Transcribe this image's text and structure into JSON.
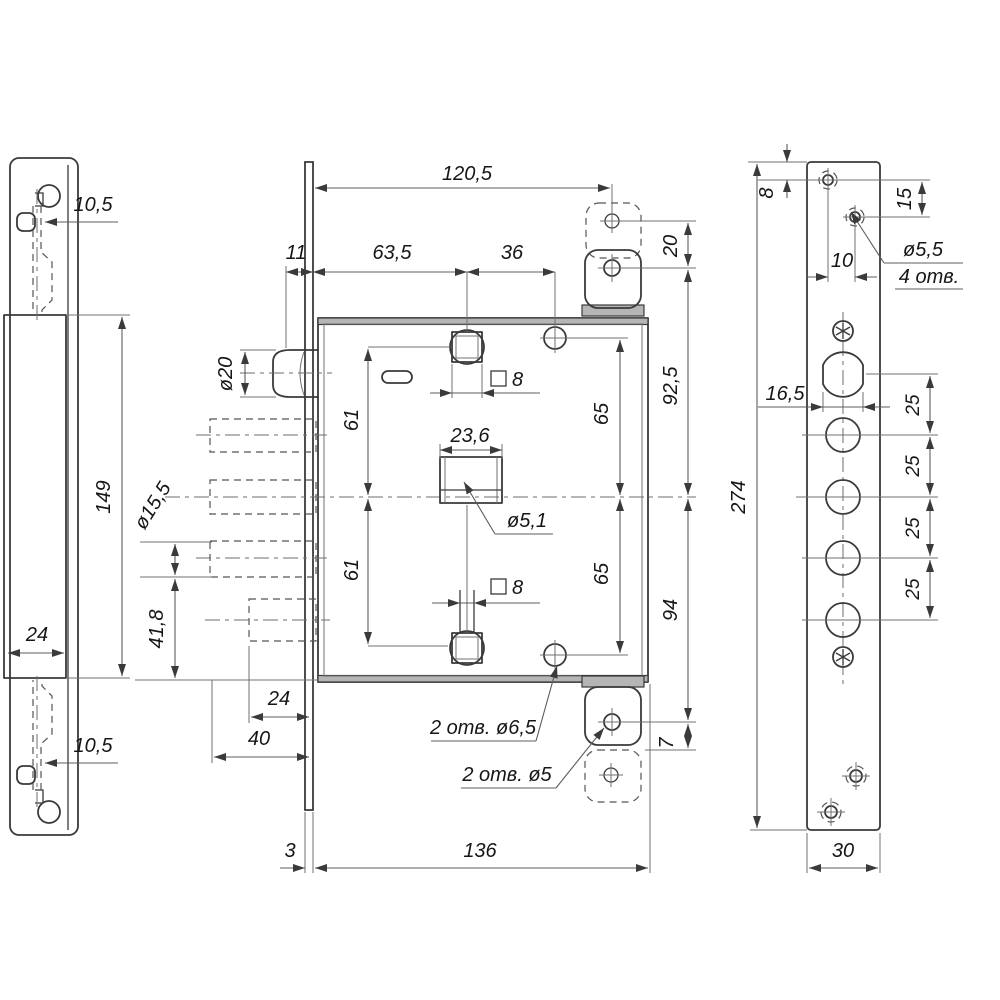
{
  "meta": {
    "drawing_type": "technical drawing, mortise lock: strike box (left), lock body (middle), faceplate (right)",
    "background": "#ffffff",
    "line_color": "#3a3a3a",
    "section_fill": "#b5b5b5"
  },
  "labels": {
    "strike_offset_top": "10,5",
    "strike_box_height": "149",
    "strike_box_width": "24",
    "strike_offset_bottom": "10,5",
    "body_overall_width": "120,5",
    "body_face_gap": "11",
    "body_backset": "63,5",
    "body_spindle_to_hole": "36",
    "keeper_hole_gap": "20",
    "body_upper_span": "92,5",
    "body_lower_span": "94",
    "keeper_lower_gap": "7",
    "spindle_upper": "61",
    "spindle_lower": "61",
    "hole_upper": "65",
    "hole_lower": "65",
    "cyl_slot_width": "23,6",
    "cyl_pin_dia": "ø5,1",
    "square_top": "8",
    "square_bottom": "8",
    "latch_dia": "ø20",
    "bolt_dia": "ø15,5",
    "bolt_edge_offset": "41,8",
    "aux_bolt_width": "24",
    "bolt_throw": "40",
    "face_thickness": "3",
    "body_width": "136",
    "note_two_holes_65": "2 отв. ø6,5",
    "note_two_holes_5": "2 отв. ø5",
    "fp_top_offset": "8",
    "fp_hole_v": "15",
    "fp_hole_h": "10",
    "fp_screw_dia": "ø5,5",
    "fp_screw_count": "4 отв.",
    "fp_cyl_width": "16,5",
    "fp_pitch": [
      "25",
      "25",
      "25",
      "25"
    ],
    "fp_height": "274",
    "fp_width": "30"
  }
}
